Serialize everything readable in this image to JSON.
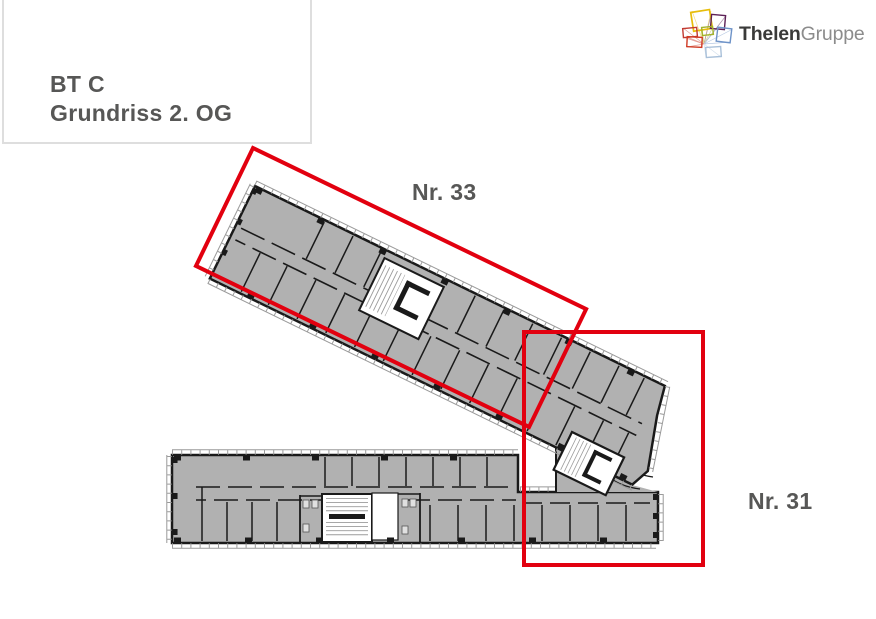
{
  "title_block": {
    "line1": "BT C",
    "line2": "Grundriss 2. OG"
  },
  "logo": {
    "brand_bold": "Thelen",
    "brand_light": "Gruppe",
    "mark_colors": [
      "#e7bd0b",
      "#5e2157",
      "#a3b32a",
      "#6e93c8",
      "#c23a31",
      "#cf3a24",
      "#a9c0d9"
    ]
  },
  "plan": {
    "areas": [
      {
        "id": "nr-33",
        "label": "Nr. 33"
      },
      {
        "id": "nr-31",
        "label": "Nr. 31"
      }
    ],
    "colors": {
      "highlight_red": "#e2000f",
      "room_fill": "#b1b1b1",
      "wall": "#1a1a1a",
      "label_text": "#575756"
    }
  }
}
